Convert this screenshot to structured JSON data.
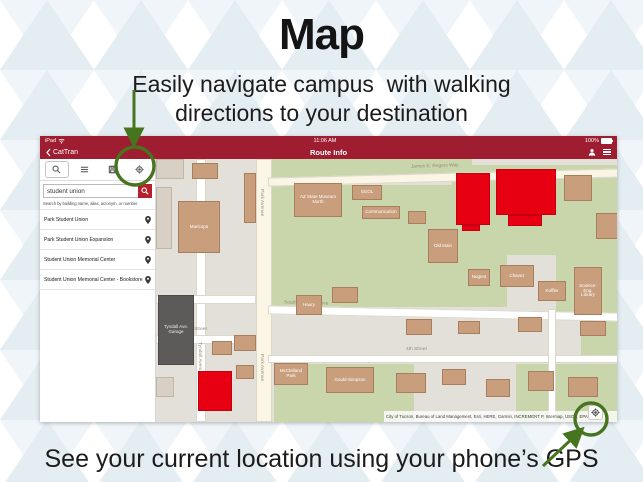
{
  "colors": {
    "header_red": "#9e1d30",
    "search_button_red": "#b5202c",
    "highlight_red": "#e60012",
    "annotation_green": "#47741e",
    "map_green": "#c9d5ab",
    "building_tan": "#c99e7c",
    "garage_gray": "#5d5b5a"
  },
  "slide": {
    "title": "Map",
    "subtitle": [
      "Easily navigate campus  with walking",
      "directions to your destination"
    ],
    "footer": "See your current location using your phone’s GPS"
  },
  "app": {
    "status_bar": {
      "device": "iPad",
      "time": "11:06 AM",
      "battery": "100%"
    },
    "nav_bar": {
      "back_label": "CatTran",
      "title": "Route Info"
    },
    "search_panel": {
      "search_value": "student union",
      "search_hint": "Search by building name, alias, acronym, or number",
      "results": [
        {
          "name": "Park Student Union"
        },
        {
          "name": "Park Student Union Expansion"
        },
        {
          "name": "Student Union Memorial Center"
        },
        {
          "name": "Student Union Memorial Center - Bookstore"
        }
      ]
    },
    "map": {
      "attribution": "City of Tucson, Bureau of Land Management, Esri, HERE, Garmin, INCREMENT P, Intermap, USGS, EPA",
      "patches": [
        {
          "x": 116,
          "y": 0,
          "w": 200,
          "h": 18
        },
        {
          "x": 116,
          "y": 26,
          "w": 235,
          "h": 122
        },
        {
          "x": 296,
          "y": 6,
          "w": 169,
          "h": 90
        },
        {
          "x": 400,
          "y": 96,
          "w": 65,
          "h": 60
        },
        {
          "x": 118,
          "y": 205,
          "w": 140,
          "h": 58
        },
        {
          "x": 360,
          "y": 205,
          "w": 105,
          "h": 58
        },
        {
          "x": 425,
          "y": 150,
          "w": 40,
          "h": 50
        }
      ],
      "roads": [
        {
          "x": 100,
          "y": 0,
          "w": 16,
          "h": 263,
          "fill": "cream"
        },
        {
          "x": 40,
          "y": 0,
          "w": 10,
          "h": 263
        },
        {
          "x": 0,
          "y": 136,
          "w": 100,
          "h": 9
        },
        {
          "x": 0,
          "y": 176,
          "w": 100,
          "h": 9
        },
        {
          "x": 112,
          "y": 14,
          "w": 353,
          "h": 9,
          "rot": -1.5,
          "fill": "cream"
        },
        {
          "x": 112,
          "y": 150,
          "w": 353,
          "h": 9,
          "rot": 1.2
        },
        {
          "x": 112,
          "y": 196,
          "w": 353,
          "h": 8
        },
        {
          "x": 392,
          "y": 150,
          "w": 8,
          "h": 113
        }
      ],
      "street_labels": [
        {
          "text": "James E. Rogers Way",
          "x": 255,
          "y": 5,
          "rot": -2
        },
        {
          "text": "Park Avenue",
          "x": 103,
          "y": 30,
          "v": true
        },
        {
          "text": "Park Avenue",
          "x": 103,
          "y": 195,
          "v": true
        },
        {
          "text": "Tyndall Avenue",
          "x": 41,
          "y": 183,
          "v": true
        },
        {
          "text": "4th Street",
          "x": 30,
          "y": 168
        },
        {
          "text": "4th Street",
          "x": 250,
          "y": 188
        },
        {
          "text": "South Campus Drive",
          "x": 128,
          "y": 142,
          "rot": 1.5
        }
      ],
      "buildings": [
        {
          "x": 0,
          "y": 0,
          "w": 28,
          "h": 20,
          "type": "pale"
        },
        {
          "x": 36,
          "y": 4,
          "w": 26,
          "h": 16,
          "type": "tan"
        },
        {
          "x": 0,
          "y": 28,
          "w": 16,
          "h": 62,
          "type": "pale"
        },
        {
          "x": 22,
          "y": 42,
          "w": 42,
          "h": 52,
          "type": "tan",
          "label": "Maricopa"
        },
        {
          "x": 88,
          "y": 14,
          "w": 12,
          "h": 50,
          "type": "tan"
        },
        {
          "x": 138,
          "y": 24,
          "w": 48,
          "h": 34,
          "type": "tan",
          "label": "AZ State Museum North"
        },
        {
          "x": 196,
          "y": 26,
          "w": 30,
          "h": 15,
          "type": "tan",
          "label": "GEOL"
        },
        {
          "x": 206,
          "y": 47,
          "w": 38,
          "h": 13,
          "type": "tan",
          "label": "Communication"
        },
        {
          "x": 252,
          "y": 52,
          "w": 18,
          "h": 13,
          "type": "tan"
        },
        {
          "x": 300,
          "y": 14,
          "w": 34,
          "h": 52,
          "type": "red"
        },
        {
          "x": 340,
          "y": 10,
          "w": 60,
          "h": 46,
          "type": "red"
        },
        {
          "x": 352,
          "y": 56,
          "w": 34,
          "h": 11,
          "type": "red"
        },
        {
          "x": 306,
          "y": 66,
          "w": 18,
          "h": 6,
          "type": "red"
        },
        {
          "x": 408,
          "y": 16,
          "w": 28,
          "h": 26,
          "type": "tan"
        },
        {
          "x": 440,
          "y": 54,
          "w": 22,
          "h": 26,
          "type": "tan"
        },
        {
          "x": 272,
          "y": 70,
          "w": 30,
          "h": 34,
          "type": "tan",
          "label": "Old Main"
        },
        {
          "x": 312,
          "y": 110,
          "w": 22,
          "h": 17,
          "type": "tan",
          "label": "Nugent"
        },
        {
          "x": 344,
          "y": 106,
          "w": 34,
          "h": 22,
          "type": "tan",
          "label": "Chavez"
        },
        {
          "x": 382,
          "y": 122,
          "w": 28,
          "h": 20,
          "type": "tan",
          "label": "Koffler"
        },
        {
          "x": 418,
          "y": 108,
          "w": 28,
          "h": 48,
          "type": "tan",
          "label": "Science-Eng. Library"
        },
        {
          "x": 140,
          "y": 136,
          "w": 26,
          "h": 20,
          "type": "tan",
          "label": "Haury"
        },
        {
          "x": 176,
          "y": 128,
          "w": 26,
          "h": 16,
          "type": "tan"
        },
        {
          "x": 250,
          "y": 160,
          "w": 26,
          "h": 16,
          "type": "tan"
        },
        {
          "x": 302,
          "y": 162,
          "w": 22,
          "h": 13,
          "type": "tan"
        },
        {
          "x": 362,
          "y": 158,
          "w": 24,
          "h": 15,
          "type": "tan"
        },
        {
          "x": 424,
          "y": 162,
          "w": 26,
          "h": 15,
          "type": "tan"
        },
        {
          "x": 118,
          "y": 204,
          "w": 34,
          "h": 22,
          "type": "tan",
          "label": "McClelland Park"
        },
        {
          "x": 170,
          "y": 208,
          "w": 48,
          "h": 26,
          "type": "tan",
          "label": "Gould-Simpson"
        },
        {
          "x": 240,
          "y": 214,
          "w": 30,
          "h": 20,
          "type": "tan"
        },
        {
          "x": 286,
          "y": 210,
          "w": 24,
          "h": 16,
          "type": "tan"
        },
        {
          "x": 330,
          "y": 220,
          "w": 24,
          "h": 18,
          "type": "tan"
        },
        {
          "x": 372,
          "y": 212,
          "w": 26,
          "h": 20,
          "type": "tan"
        },
        {
          "x": 412,
          "y": 218,
          "w": 30,
          "h": 20,
          "type": "tan"
        },
        {
          "x": 2,
          "y": 136,
          "w": 36,
          "h": 70,
          "type": "dark",
          "label": "Tyndall Ave. Garage"
        },
        {
          "x": 56,
          "y": 182,
          "w": 20,
          "h": 14,
          "type": "tan"
        },
        {
          "x": 78,
          "y": 176,
          "w": 22,
          "h": 16,
          "type": "tan"
        },
        {
          "x": 80,
          "y": 206,
          "w": 18,
          "h": 14,
          "type": "tan"
        },
        {
          "x": 0,
          "y": 218,
          "w": 18,
          "h": 20,
          "type": "pale"
        },
        {
          "x": 42,
          "y": 212,
          "w": 34,
          "h": 40,
          "type": "red"
        }
      ]
    }
  }
}
